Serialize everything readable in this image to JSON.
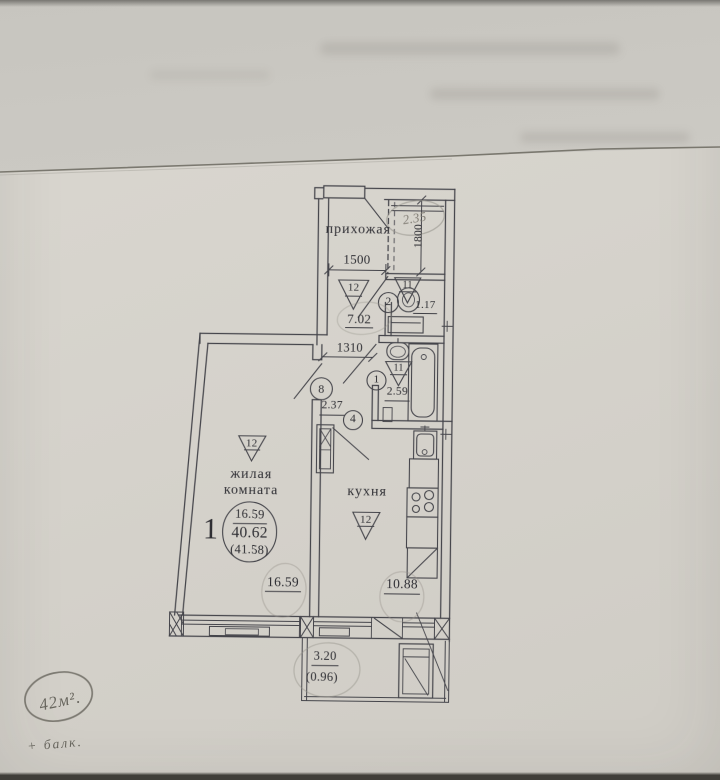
{
  "floor_plan": {
    "apartment": {
      "number": "1",
      "living_area": "16.59",
      "total_area": "40.62",
      "total_area_with_balcony": "(41.58)"
    },
    "rooms": {
      "hallway": {
        "label": "прихожая",
        "area": "7.02",
        "triangle": "12"
      },
      "toilet": {
        "area": "1.17",
        "triangle": "11"
      },
      "bathroom": {
        "area": "2.59",
        "triangle": "11"
      },
      "corridor": {
        "area": "2.37"
      },
      "living_room": {
        "label_line1": "жилая",
        "label_line2": "комната",
        "area": "16.59",
        "triangle": "12"
      },
      "kitchen": {
        "label": "кухня",
        "area": "10.88",
        "triangle": "12"
      },
      "balcony": {
        "area": "3.20",
        "coefficient": "(0.96)"
      }
    },
    "circle_marks": {
      "c1": "1",
      "c2": "2",
      "c4": "4",
      "c8": "8"
    },
    "dimensions": {
      "hallway_width_mm": "1500",
      "corridor_width_mm": "1310",
      "closet_depth_mm": "1800"
    },
    "handwritten": {
      "closet_area": "2.35",
      "total_area_note": "42м².",
      "balcony_note": "+ балк."
    }
  }
}
